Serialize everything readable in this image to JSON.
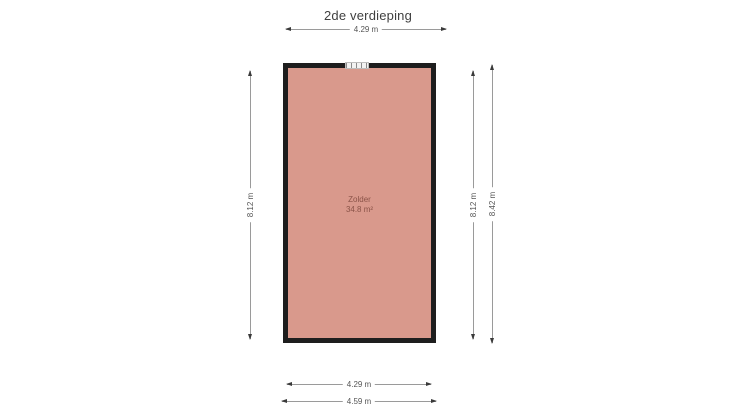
{
  "title": "2de verdieping",
  "room": {
    "name": "Zolder",
    "area": "34.8 m²"
  },
  "dimensions": {
    "top": "4.29 m",
    "left": "8.12 m",
    "right_inner": "8.12 m",
    "right_outer": "8.42 m",
    "bottom_inner": "4.29 m",
    "bottom_outer": "4.59 m"
  },
  "icons": {
    "window": "window-icon"
  },
  "colors": {
    "background": "#ffffff",
    "wall": "#1e1e1e",
    "room_fill": "#d9998c",
    "dim_line": "#9a9a9a",
    "dim_text": "#555555",
    "room_text": "#8a5348",
    "title_text": "#3f3f3f"
  }
}
